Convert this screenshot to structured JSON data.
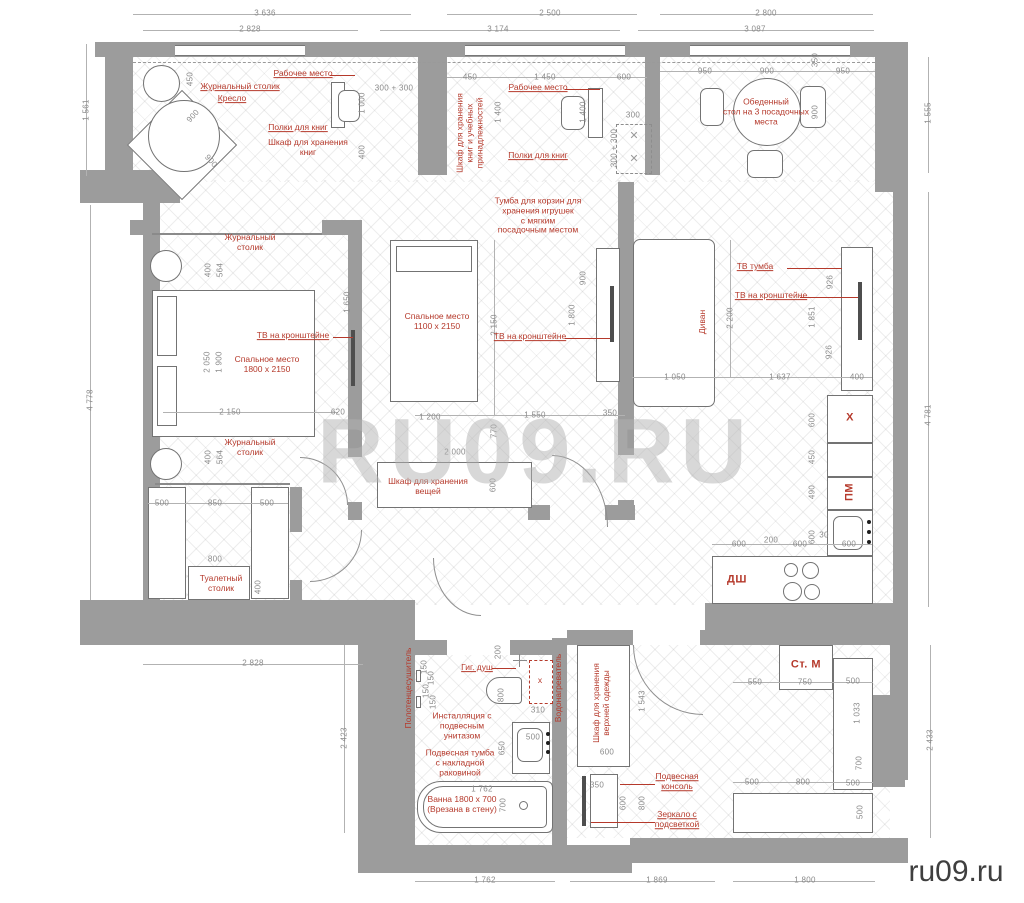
{
  "watermark": {
    "center": "RU09.RU",
    "corner": "ru09.ru"
  },
  "colors": {
    "wall": "#9c9c9c",
    "label_red": "#b5392b",
    "dim_gray": "#8a8a8a"
  },
  "dims": [
    {
      "t": "3 636",
      "x": 265,
      "y": 13
    },
    {
      "t": "2 500",
      "x": 550,
      "y": 13
    },
    {
      "t": "2 800",
      "x": 766,
      "y": 13
    },
    {
      "t": "2 828",
      "x": 250,
      "y": 29
    },
    {
      "t": "3 174",
      "x": 498,
      "y": 29
    },
    {
      "t": "3 087",
      "x": 755,
      "y": 29
    },
    {
      "t": "1 561",
      "x": 86,
      "y": 110,
      "r": -90
    },
    {
      "t": "4 778",
      "x": 90,
      "y": 400,
      "r": -90
    },
    {
      "t": "2 423",
      "x": 344,
      "y": 738,
      "r": -90
    },
    {
      "t": "1 555",
      "x": 928,
      "y": 113,
      "r": -90
    },
    {
      "t": "4 781",
      "x": 928,
      "y": 415,
      "r": -90
    },
    {
      "t": "2 433",
      "x": 930,
      "y": 740,
      "r": -90
    },
    {
      "t": "2 828",
      "x": 253,
      "y": 663
    },
    {
      "t": "1 762",
      "x": 485,
      "y": 880
    },
    {
      "t": "1 869",
      "x": 657,
      "y": 880
    },
    {
      "t": "1 800",
      "x": 805,
      "y": 880
    },
    {
      "t": "450",
      "x": 190,
      "y": 79,
      "r": -90
    },
    {
      "t": "900",
      "x": 193,
      "y": 116,
      "r": -48
    },
    {
      "t": "900",
      "x": 211,
      "y": 161,
      "r": 48
    },
    {
      "t": "300 + 300",
      "x": 394,
      "y": 88
    },
    {
      "t": "1 000",
      "x": 362,
      "y": 103,
      "r": -90
    },
    {
      "t": "400",
      "x": 362,
      "y": 152,
      "r": -90
    },
    {
      "t": "450",
      "x": 470,
      "y": 77
    },
    {
      "t": "1 450",
      "x": 545,
      "y": 77
    },
    {
      "t": "600",
      "x": 624,
      "y": 77
    },
    {
      "t": "1 400",
      "x": 498,
      "y": 112,
      "r": -90
    },
    {
      "t": "1 400",
      "x": 583,
      "y": 112,
      "r": -90
    },
    {
      "t": "300",
      "x": 633,
      "y": 115
    },
    {
      "t": "300 + 300",
      "x": 614,
      "y": 148,
      "r": -90
    },
    {
      "t": "950",
      "x": 705,
      "y": 71
    },
    {
      "t": "900",
      "x": 767,
      "y": 71
    },
    {
      "t": "350",
      "x": 815,
      "y": 60,
      "r": -90
    },
    {
      "t": "950",
      "x": 843,
      "y": 71
    },
    {
      "t": "900",
      "x": 815,
      "y": 112,
      "r": -90
    },
    {
      "t": "400",
      "x": 208,
      "y": 270,
      "r": -90
    },
    {
      "t": "564",
      "x": 220,
      "y": 270,
      "r": -90
    },
    {
      "t": "2 050",
      "x": 207,
      "y": 362,
      "r": -90
    },
    {
      "t": "1 900",
      "x": 219,
      "y": 362,
      "r": -90
    },
    {
      "t": "2 150",
      "x": 230,
      "y": 412
    },
    {
      "t": "620",
      "x": 338,
      "y": 412
    },
    {
      "t": "1 650",
      "x": 347,
      "y": 302,
      "r": -90
    },
    {
      "t": "400",
      "x": 208,
      "y": 457,
      "r": -90
    },
    {
      "t": "564",
      "x": 220,
      "y": 457,
      "r": -90
    },
    {
      "t": "2 150",
      "x": 494,
      "y": 325,
      "r": -90
    },
    {
      "t": "1 200",
      "x": 430,
      "y": 417
    },
    {
      "t": "1 550",
      "x": 535,
      "y": 415
    },
    {
      "t": "350",
      "x": 610,
      "y": 413
    },
    {
      "t": "770",
      "x": 494,
      "y": 431,
      "r": -90
    },
    {
      "t": "900",
      "x": 583,
      "y": 278,
      "r": -90
    },
    {
      "t": "1 800",
      "x": 572,
      "y": 315,
      "r": -90
    },
    {
      "t": "2 200",
      "x": 730,
      "y": 318,
      "r": -90
    },
    {
      "t": "926",
      "x": 830,
      "y": 282,
      "r": -90
    },
    {
      "t": "1 851",
      "x": 812,
      "y": 317,
      "r": -90
    },
    {
      "t": "926",
      "x": 829,
      "y": 352,
      "r": -90
    },
    {
      "t": "1 050",
      "x": 675,
      "y": 377
    },
    {
      "t": "1 637",
      "x": 780,
      "y": 377
    },
    {
      "t": "400",
      "x": 857,
      "y": 377
    },
    {
      "t": "600",
      "x": 812,
      "y": 420,
      "r": -90
    },
    {
      "t": "450",
      "x": 812,
      "y": 457,
      "r": -90
    },
    {
      "t": "490",
      "x": 812,
      "y": 492,
      "r": -90
    },
    {
      "t": "600",
      "x": 812,
      "y": 537,
      "r": -90
    },
    {
      "t": "30",
      "x": 824,
      "y": 535
    },
    {
      "t": "600",
      "x": 849,
      "y": 544
    },
    {
      "t": "600",
      "x": 739,
      "y": 544
    },
    {
      "t": "200",
      "x": 771,
      "y": 540
    },
    {
      "t": "600",
      "x": 800,
      "y": 544
    },
    {
      "t": "2 000",
      "x": 455,
      "y": 452
    },
    {
      "t": "600",
      "x": 493,
      "y": 485,
      "r": -90
    },
    {
      "t": "500",
      "x": 162,
      "y": 503
    },
    {
      "t": "850",
      "x": 215,
      "y": 503
    },
    {
      "t": "500",
      "x": 267,
      "y": 503
    },
    {
      "t": "800",
      "x": 215,
      "y": 559
    },
    {
      "t": "400",
      "x": 258,
      "y": 587,
      "r": -90
    },
    {
      "t": "200",
      "x": 498,
      "y": 652,
      "r": -90
    },
    {
      "t": "150",
      "x": 424,
      "y": 667,
      "r": -90
    },
    {
      "t": "150",
      "x": 431,
      "y": 678,
      "r": -90
    },
    {
      "t": "150",
      "x": 426,
      "y": 691,
      "r": -90
    },
    {
      "t": "150",
      "x": 433,
      "y": 702,
      "r": -90
    },
    {
      "t": "800",
      "x": 501,
      "y": 695,
      "r": -90
    },
    {
      "t": "310",
      "x": 538,
      "y": 710
    },
    {
      "t": "650",
      "x": 502,
      "y": 748,
      "r": -90
    },
    {
      "t": "500",
      "x": 533,
      "y": 737
    },
    {
      "t": "1 762",
      "x": 482,
      "y": 789
    },
    {
      "t": "700",
      "x": 503,
      "y": 805,
      "r": -90
    },
    {
      "t": "350",
      "x": 597,
      "y": 785
    },
    {
      "t": "1 543",
      "x": 642,
      "y": 701,
      "r": -90
    },
    {
      "t": "600",
      "x": 607,
      "y": 752
    },
    {
      "t": "600",
      "x": 623,
      "y": 803,
      "r": -90
    },
    {
      "t": "800",
      "x": 642,
      "y": 803,
      "r": -90
    },
    {
      "t": "550",
      "x": 755,
      "y": 682
    },
    {
      "t": "750",
      "x": 805,
      "y": 682
    },
    {
      "t": "500",
      "x": 853,
      "y": 681
    },
    {
      "t": "1 033",
      "x": 857,
      "y": 713,
      "r": -90
    },
    {
      "t": "700",
      "x": 859,
      "y": 763,
      "r": -90
    },
    {
      "t": "500",
      "x": 752,
      "y": 782
    },
    {
      "t": "800",
      "x": 803,
      "y": 782
    },
    {
      "t": "500",
      "x": 853,
      "y": 783
    },
    {
      "t": "500",
      "x": 860,
      "y": 812,
      "r": -90
    }
  ],
  "labels": [
    {
      "t": "Рабочее место",
      "x": 303,
      "y": 74,
      "u": 1
    },
    {
      "t": "Журнальный столик",
      "x": 240,
      "y": 87,
      "u": 1
    },
    {
      "t": "Кресло",
      "x": 232,
      "y": 99,
      "u": 1
    },
    {
      "t": "Полки для книг",
      "x": 298,
      "y": 128,
      "u": 1
    },
    {
      "t": "Шкаф для хранения\nкниг",
      "x": 308,
      "y": 148
    },
    {
      "t": "Шкаф для хранения\nкниг и учебных\nпринадлежностей",
      "x": 470,
      "y": 133,
      "r": -90
    },
    {
      "t": "Рабочее место",
      "x": 538,
      "y": 88,
      "u": 1
    },
    {
      "t": "Полки для книг",
      "x": 538,
      "y": 156,
      "u": 1
    },
    {
      "t": "Тумба для корзин для\nхранения игрушек\nс мягким\nпосадочным местом",
      "x": 538,
      "y": 216
    },
    {
      "t": "Обеденный\nстол на 3 посадочных\nместа",
      "x": 766,
      "y": 112
    },
    {
      "t": "Журнальный\nстолик",
      "x": 250,
      "y": 243
    },
    {
      "t": "ТВ на кронштейне",
      "x": 293,
      "y": 336,
      "u": 1
    },
    {
      "t": "Спальное место\n1800 х 2150",
      "x": 267,
      "y": 365
    },
    {
      "t": "Журнальный\nстолик",
      "x": 250,
      "y": 448
    },
    {
      "t": "Спальное место\n1100 х 2150",
      "x": 437,
      "y": 322
    },
    {
      "t": "ТВ на кронштейне",
      "x": 530,
      "y": 337,
      "u": 1
    },
    {
      "t": "Диван",
      "x": 703,
      "y": 322,
      "r": -90
    },
    {
      "t": "ТВ тумба",
      "x": 755,
      "y": 267,
      "u": 1
    },
    {
      "t": "ТВ на кронштейне",
      "x": 771,
      "y": 296,
      "u": 1
    },
    {
      "t": "X",
      "x": 850,
      "y": 418,
      "big": 1
    },
    {
      "t": "ПМ",
      "x": 850,
      "y": 492,
      "r": -90,
      "big": 1
    },
    {
      "t": "ДШ",
      "x": 737,
      "y": 580,
      "big": 1
    },
    {
      "t": "Туалетный\nстолик",
      "x": 221,
      "y": 584
    },
    {
      "t": "Шкаф для хранения\nвещей",
      "x": 428,
      "y": 487
    },
    {
      "t": "Полотенцесушитель",
      "x": 409,
      "y": 688,
      "r": -90
    },
    {
      "t": "Гиг. душ",
      "x": 477,
      "y": 668,
      "u": 1
    },
    {
      "t": "Инсталляция с\nподвесным\nунитазом",
      "x": 462,
      "y": 726
    },
    {
      "t": "Подвесная тумба\nс накладной\nраковиной",
      "x": 460,
      "y": 763
    },
    {
      "t": "х",
      "x": 540,
      "y": 681
    },
    {
      "t": "Водонагреватель",
      "x": 559,
      "y": 688,
      "r": -90
    },
    {
      "t": "Ванна 1800 х 700\n(Врезана в стену)",
      "x": 462,
      "y": 805
    },
    {
      "t": "Шкаф для хранения\nверхней одежды",
      "x": 602,
      "y": 703,
      "r": -90
    },
    {
      "t": "Подвесная\nконсоль",
      "x": 677,
      "y": 782,
      "u": 1
    },
    {
      "t": "Зеркало с\nподсветкой",
      "x": 677,
      "y": 820,
      "u": 1
    },
    {
      "t": "Ст. М",
      "x": 806,
      "y": 665,
      "big": 1
    }
  ]
}
